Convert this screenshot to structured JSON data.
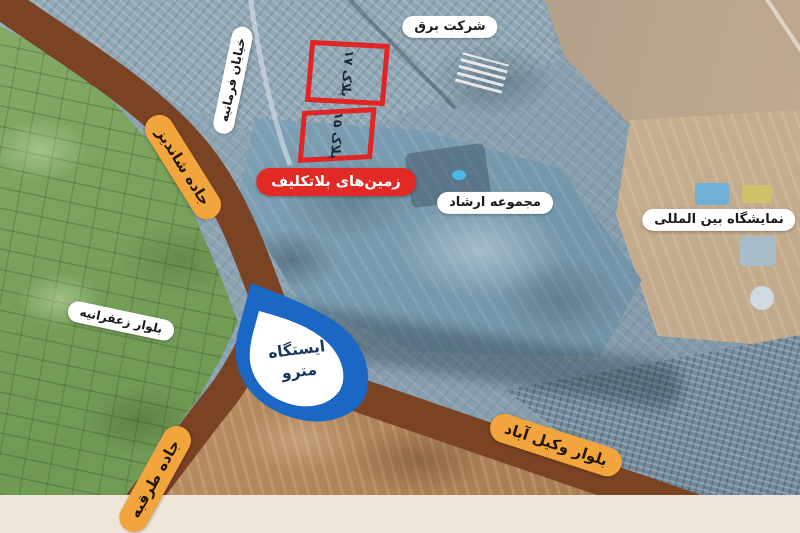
{
  "map": {
    "area_labels": {
      "electric_company": "شرکت برق",
      "ershad_complex": "مجموعه ارشاد",
      "intl_exhibition": "نمایشگاه بین المللی",
      "undecided_lands": "زمین‌های بلاتکلیف"
    },
    "road_labels": {
      "farmanieh_st": "خیابان فرمانیه",
      "shandiz_rd": "جاده شاندیز",
      "zafaraniyeh_blvd": "بلوار زعفرانیه",
      "torqabeh_rd": "جاده طرقبه",
      "vakilabad_blvd": "بلوار وکیل آباد"
    },
    "plots": {
      "plot_17": "پلاک ۱۷",
      "plot_15": "پلاک ۱۵"
    },
    "metro": {
      "line1": "ایستگاه",
      "line2": "مترو"
    },
    "colors": {
      "road_brown": "#7a4323",
      "road_label_orange": "#f2a53c",
      "alert_red": "#e12a26",
      "plot_outline_red": "#e12424",
      "metro_blue": "#1b67c5",
      "metro_text_navy": "#17375f",
      "white_label_bg": "#ffffff",
      "footer_beige": "#eee6d9"
    }
  }
}
